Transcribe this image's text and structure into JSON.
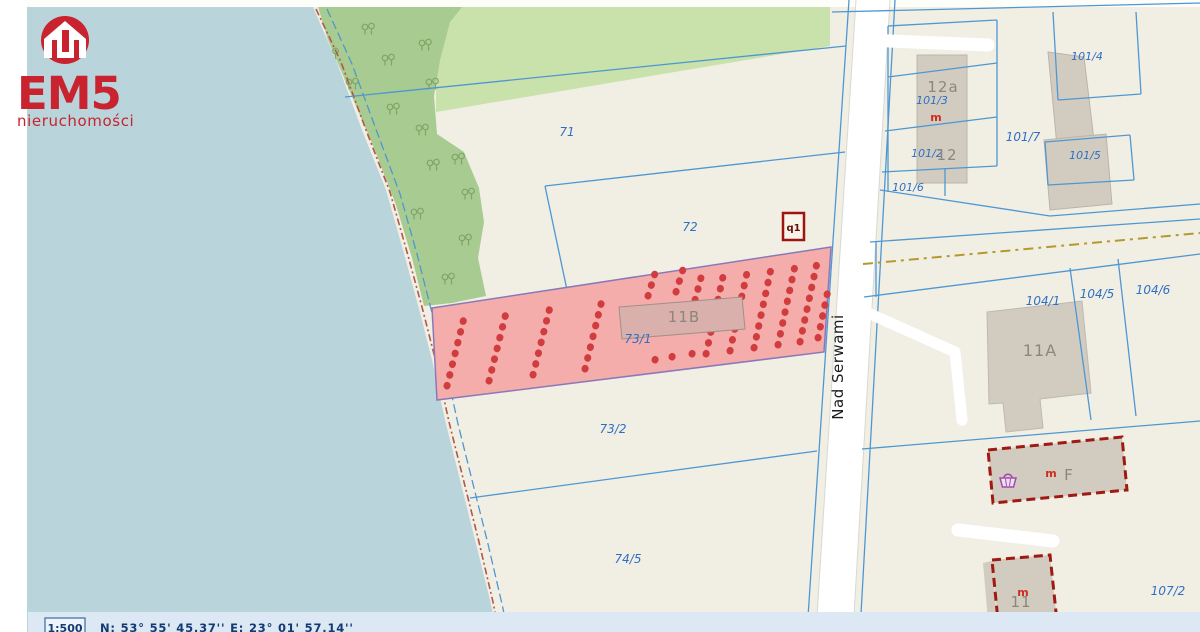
{
  "logo": {
    "brand": "EM5",
    "subtitle": "nieruchomości"
  },
  "map": {
    "street": {
      "name": "Nad Serwami"
    },
    "marker": {
      "label": "q1"
    },
    "parcels": {
      "highlighted": "73/1",
      "labels": [
        {
          "id": "71"
        },
        {
          "id": "72"
        },
        {
          "id": "73/1"
        },
        {
          "id": "73/2"
        },
        {
          "id": "74/5"
        },
        {
          "id": "101/3"
        },
        {
          "id": "101/2"
        },
        {
          "id": "101/4"
        },
        {
          "id": "101/5"
        },
        {
          "id": "101/6"
        },
        {
          "id": "101/7"
        },
        {
          "id": "104/1"
        },
        {
          "id": "104/5"
        },
        {
          "id": "104/6"
        },
        {
          "id": "107/2"
        }
      ]
    },
    "buildings": {
      "symbol_residential": "m",
      "labels": [
        {
          "id": "12a"
        },
        {
          "id": "12"
        },
        {
          "id": "11A"
        },
        {
          "id": "11B"
        },
        {
          "id": "F"
        },
        {
          "id": "11"
        }
      ]
    }
  },
  "statusbar": {
    "scale": "1:500",
    "coordinates": "N: 53° 55' 45.37''   E: 23° 01' 57.14''"
  },
  "colors": {
    "water": "#b9d4db",
    "land": "#f1efe4",
    "forest_dark": "#a7cb90",
    "forest_light": "#c9e1ab",
    "boundary_blue": "#4f97d2",
    "parcel_label_blue": "#2e6fc4",
    "highlight_fill": "#f4adaa",
    "highlight_border": "#8a79b8",
    "selection_red": "#d13c3f",
    "building_fill": "#d2cbc0",
    "building_outline_red": "#9e1a12",
    "road": "#ffffff",
    "powerline_olive": "#b5992f",
    "shoreline_red": "#b3574d",
    "statusbar_bg": "#dce8f3",
    "logo_red": "#c8232e",
    "basket_purple": "#a34ab0"
  }
}
